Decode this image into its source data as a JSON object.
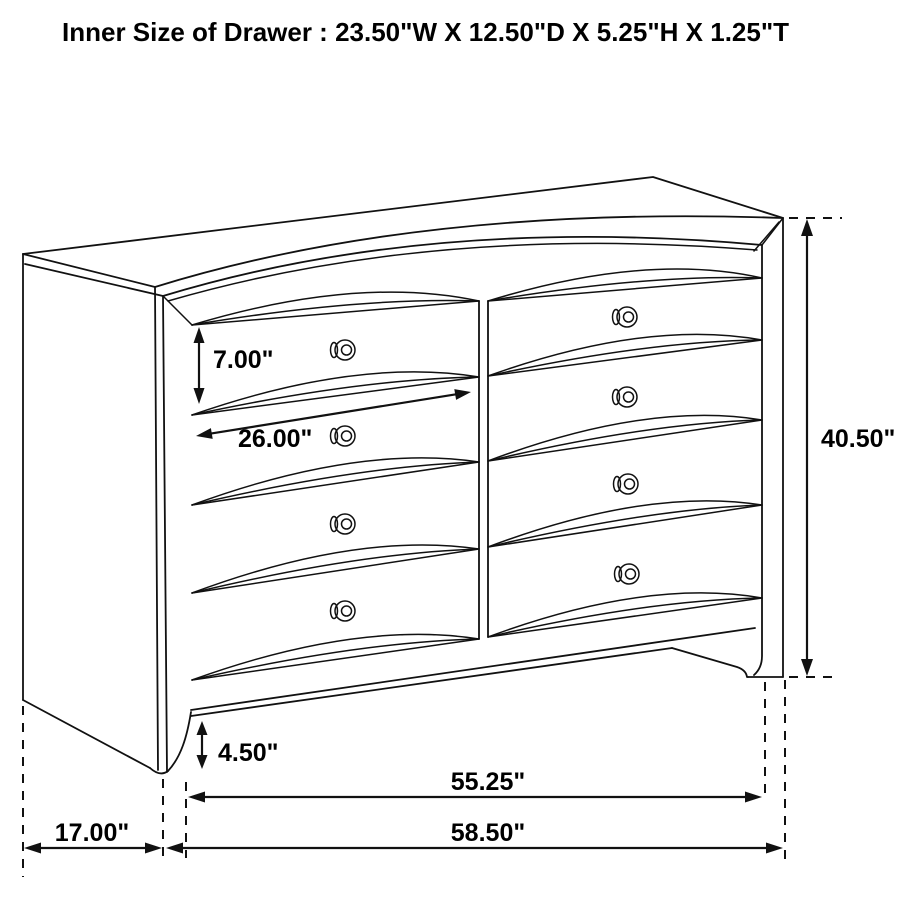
{
  "title": "Inner Size of Drawer : 23.50\"W X 12.50\"D X 5.25\"H X 1.25\"T",
  "dimensions": {
    "drawer_front_height": "7.00\"",
    "drawer_width": "26.00\"",
    "overall_height": "40.50\"",
    "base_height": "4.50\"",
    "front_width": "55.25\"",
    "overall_width": "58.50\"",
    "side_depth": "17.00\""
  }
}
